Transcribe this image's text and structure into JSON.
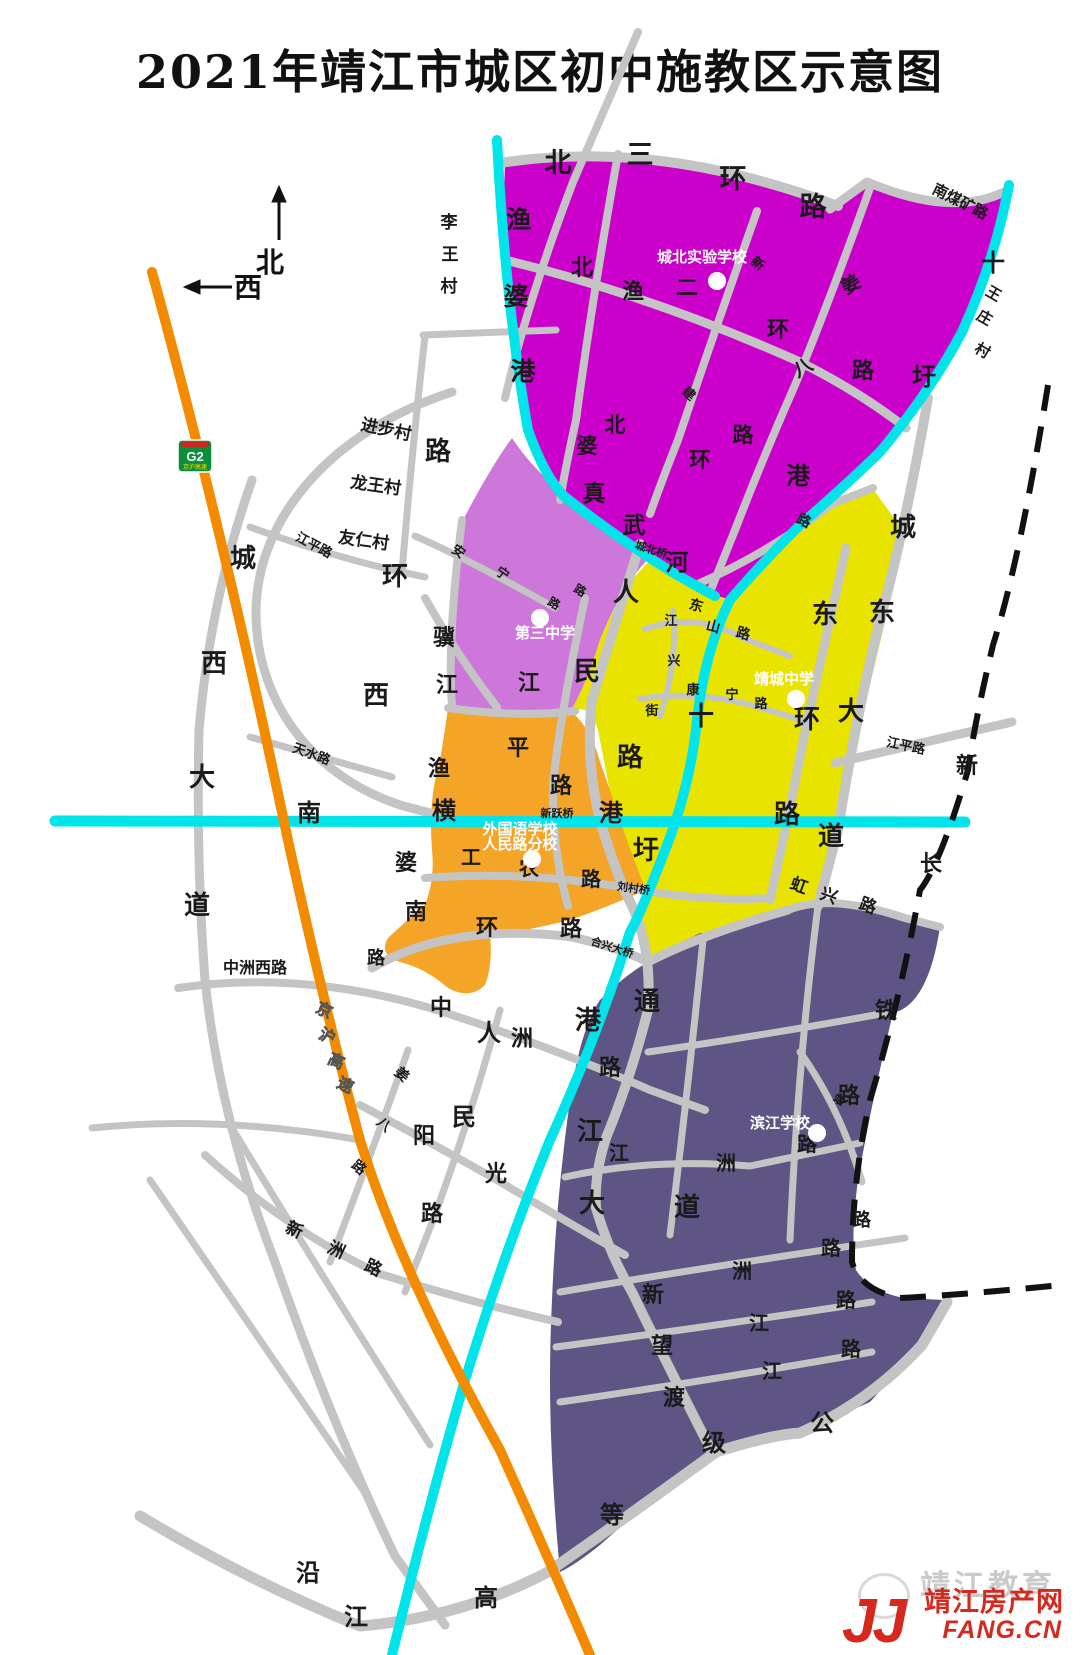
{
  "title": "2021年靖江市城区初中施教区示意图",
  "compass": {
    "north": "北",
    "west": "西"
  },
  "highway_badge": {
    "code": "G2",
    "name": "京沪高速"
  },
  "colors": {
    "district_north": "#cb00cb",
    "district_third": "#cc77d9",
    "district_jingcheng": "#e8e400",
    "district_foreign": "#f4a427",
    "district_binjiang": "#5e5584",
    "road": "#c4c4c4",
    "water": "#00e4ea",
    "highway": "#f28b00",
    "railway": "#111111",
    "label": "#1a1a1a",
    "school_text": "#ffffff",
    "highway_label": "#ffe000",
    "watermark_red": "#d5281e"
  },
  "regions": [
    {
      "school": "城北实验学校",
      "color_key": "district_north"
    },
    {
      "school": "第三中学",
      "color_key": "district_third"
    },
    {
      "school": "靖城中学",
      "color_key": "district_jingcheng"
    },
    {
      "school": "外国语学校人民路分校",
      "color_key": "district_foreign"
    },
    {
      "school": "滨江学校",
      "color_key": "district_binjiang"
    }
  ],
  "schools": [
    {
      "name": "城北实验学校",
      "tx": 702,
      "ty": 262,
      "dx": 717,
      "dy": 281
    },
    {
      "name": "第三中学",
      "tx": 545,
      "ty": 638,
      "dx": 540,
      "dy": 618
    },
    {
      "name": "靖城中学",
      "tx": 784,
      "ty": 684,
      "dx": 796,
      "dy": 699
    },
    {
      "name": "外国语学校",
      "name2": "人民路分校",
      "tx": 520,
      "ty": 834,
      "ty2": 849,
      "dx": 532,
      "dy": 859
    },
    {
      "name": "滨江学校",
      "tx": 780,
      "ty": 1128,
      "dx": 817,
      "dy": 1133
    }
  ],
  "bridges": [
    {
      "t": "城北桥",
      "x": 650,
      "y": 553,
      "s": 11,
      "r": 18
    },
    {
      "t": "新跃桥",
      "x": 557,
      "y": 817,
      "s": 11,
      "r": 0
    },
    {
      "t": "刘村桥",
      "x": 633,
      "y": 892,
      "s": 11,
      "r": 8
    },
    {
      "t": "合兴大桥",
      "x": 611,
      "y": 951,
      "s": 11,
      "r": 18
    }
  ],
  "map_labels": [
    {
      "t": "北",
      "x": 558,
      "y": 172,
      "s": 27
    },
    {
      "t": "三",
      "x": 640,
      "y": 164,
      "s": 27
    },
    {
      "t": "环",
      "x": 733,
      "y": 188,
      "s": 27
    },
    {
      "t": "路",
      "x": 813,
      "y": 216,
      "s": 27
    },
    {
      "t": "南煤矿路",
      "x": 958,
      "y": 206,
      "s": 15,
      "r": 27
    },
    {
      "t": "李",
      "x": 449,
      "y": 228,
      "s": 17
    },
    {
      "t": "王",
      "x": 450,
      "y": 260,
      "s": 17
    },
    {
      "t": "村",
      "x": 449,
      "y": 292,
      "s": 17
    },
    {
      "t": "渔",
      "x": 519,
      "y": 228,
      "s": 25
    },
    {
      "t": "婆",
      "x": 516,
      "y": 305,
      "s": 25
    },
    {
      "t": "港",
      "x": 523,
      "y": 380,
      "s": 25
    },
    {
      "t": "十",
      "x": 993,
      "y": 271,
      "s": 24
    },
    {
      "t": "圩",
      "x": 924,
      "y": 385,
      "s": 24
    },
    {
      "t": "港",
      "x": 798,
      "y": 484,
      "s": 24
    },
    {
      "t": "王",
      "x": 991,
      "y": 298,
      "s": 15,
      "r": 30
    },
    {
      "t": "庄",
      "x": 982,
      "y": 322,
      "s": 15,
      "r": 30
    },
    {
      "t": "村",
      "x": 980,
      "y": 355,
      "s": 15,
      "r": 30
    },
    {
      "t": "新",
      "x": 755,
      "y": 267,
      "s": 13,
      "r": 40
    },
    {
      "t": "建",
      "x": 686,
      "y": 397,
      "s": 13,
      "r": 40
    },
    {
      "t": "北",
      "x": 582,
      "y": 275,
      "s": 22
    },
    {
      "t": "二",
      "x": 687,
      "y": 295,
      "s": 22
    },
    {
      "t": "环",
      "x": 778,
      "y": 337,
      "s": 22
    },
    {
      "t": "路",
      "x": 863,
      "y": 378,
      "s": 22
    },
    {
      "t": "姜",
      "x": 854,
      "y": 290,
      "s": 19,
      "r": -30
    },
    {
      "t": "八",
      "x": 806,
      "y": 373,
      "s": 19,
      "r": -30
    },
    {
      "t": "路",
      "x": 802,
      "y": 525,
      "s": 14,
      "r": 25
    },
    {
      "t": "渔",
      "x": 633,
      "y": 299,
      "s": 22
    },
    {
      "t": "真",
      "x": 594,
      "y": 501,
      "s": 23
    },
    {
      "t": "武",
      "x": 634,
      "y": 533,
      "s": 23
    },
    {
      "t": "河",
      "x": 677,
      "y": 570,
      "s": 23
    },
    {
      "t": "北",
      "x": 615,
      "y": 432,
      "s": 21
    },
    {
      "t": "婆",
      "x": 587,
      "y": 453,
      "s": 21
    },
    {
      "t": "环",
      "x": 700,
      "y": 467,
      "s": 21
    },
    {
      "t": "路",
      "x": 743,
      "y": 442,
      "s": 21
    },
    {
      "t": "城",
      "x": 903,
      "y": 536,
      "s": 26
    },
    {
      "t": "东",
      "x": 882,
      "y": 621,
      "s": 26
    },
    {
      "t": "大",
      "x": 851,
      "y": 720,
      "s": 26
    },
    {
      "t": "道",
      "x": 831,
      "y": 845,
      "s": 26
    },
    {
      "t": "东",
      "x": 825,
      "y": 623,
      "s": 26
    },
    {
      "t": "环",
      "x": 807,
      "y": 728,
      "s": 26
    },
    {
      "t": "路",
      "x": 787,
      "y": 823,
      "s": 26
    },
    {
      "t": "江平路",
      "x": 905,
      "y": 750,
      "s": 13,
      "r": 12
    },
    {
      "t": "江平路",
      "x": 312,
      "y": 549,
      "s": 13,
      "r": 28
    },
    {
      "t": "十",
      "x": 701,
      "y": 725,
      "s": 26
    },
    {
      "t": "圩",
      "x": 646,
      "y": 859,
      "s": 26
    },
    {
      "t": "港",
      "x": 588,
      "y": 1029,
      "s": 26
    },
    {
      "t": "东",
      "x": 695,
      "y": 610,
      "s": 14,
      "r": 15
    },
    {
      "t": "山",
      "x": 712,
      "y": 631,
      "s": 14,
      "r": 15
    },
    {
      "t": "路",
      "x": 742,
      "y": 638,
      "s": 14,
      "r": 15
    },
    {
      "t": "康",
      "x": 693,
      "y": 694,
      "s": 13
    },
    {
      "t": "宁",
      "x": 732,
      "y": 699,
      "s": 13
    },
    {
      "t": "路",
      "x": 761,
      "y": 708,
      "s": 13
    },
    {
      "t": "江",
      "x": 671,
      "y": 625,
      "s": 13
    },
    {
      "t": "兴",
      "x": 674,
      "y": 665,
      "s": 13
    },
    {
      "t": "街",
      "x": 652,
      "y": 715,
      "s": 13
    },
    {
      "t": "人",
      "x": 626,
      "y": 601,
      "s": 26
    },
    {
      "t": "民",
      "x": 587,
      "y": 680,
      "s": 26
    },
    {
      "t": "路",
      "x": 630,
      "y": 766,
      "s": 26
    },
    {
      "t": "骥",
      "x": 444,
      "y": 645,
      "s": 22
    },
    {
      "t": "江",
      "x": 447,
      "y": 692,
      "s": 22
    },
    {
      "t": "江",
      "x": 529,
      "y": 690,
      "s": 22
    },
    {
      "t": "平",
      "x": 518,
      "y": 755,
      "s": 22
    },
    {
      "t": "路",
      "x": 561,
      "y": 793,
      "s": 22
    },
    {
      "t": "路",
      "x": 438,
      "y": 460,
      "s": 26
    },
    {
      "t": "环",
      "x": 395,
      "y": 585,
      "s": 26
    },
    {
      "t": "西",
      "x": 376,
      "y": 704,
      "s": 26
    },
    {
      "t": "城",
      "x": 243,
      "y": 567,
      "s": 26
    },
    {
      "t": "西",
      "x": 214,
      "y": 672,
      "s": 26
    },
    {
      "t": "大",
      "x": 202,
      "y": 786,
      "s": 26
    },
    {
      "t": "道",
      "x": 197,
      "y": 914,
      "s": 26
    },
    {
      "t": "进步村",
      "x": 385,
      "y": 435,
      "s": 17,
      "r": 12
    },
    {
      "t": "龙王村",
      "x": 375,
      "y": 491,
      "s": 17,
      "r": 8
    },
    {
      "t": "友仁村",
      "x": 363,
      "y": 546,
      "s": 17,
      "r": 8
    },
    {
      "t": "安",
      "x": 456,
      "y": 555,
      "s": 13,
      "r": 35
    },
    {
      "t": "宁",
      "x": 500,
      "y": 577,
      "s": 13,
      "r": 35
    },
    {
      "t": "路",
      "x": 552,
      "y": 607,
      "s": 12,
      "r": 30
    },
    {
      "t": "路",
      "x": 578,
      "y": 594,
      "s": 12,
      "r": 30
    },
    {
      "t": "天水路",
      "x": 310,
      "y": 758,
      "s": 13,
      "r": 20
    },
    {
      "t": "南",
      "x": 309,
      "y": 821,
      "s": 24
    },
    {
      "t": "横",
      "x": 444,
      "y": 819,
      "s": 24
    },
    {
      "t": "港",
      "x": 611,
      "y": 821,
      "s": 24
    },
    {
      "t": "渔",
      "x": 439,
      "y": 776,
      "s": 22
    },
    {
      "t": "婆",
      "x": 406,
      "y": 870,
      "s": 22
    },
    {
      "t": "南",
      "x": 416,
      "y": 919,
      "s": 22
    },
    {
      "t": "环",
      "x": 487,
      "y": 935,
      "s": 22
    },
    {
      "t": "路",
      "x": 571,
      "y": 936,
      "s": 22
    },
    {
      "t": "路",
      "x": 376,
      "y": 964,
      "s": 18
    },
    {
      "t": "工",
      "x": 471,
      "y": 864,
      "s": 20
    },
    {
      "t": "农",
      "x": 529,
      "y": 875,
      "s": 20
    },
    {
      "t": "路",
      "x": 591,
      "y": 886,
      "s": 20
    },
    {
      "t": "虹",
      "x": 797,
      "y": 891,
      "s": 17,
      "r": 20
    },
    {
      "t": "兴",
      "x": 827,
      "y": 901,
      "s": 17,
      "r": 20
    },
    {
      "t": "路",
      "x": 866,
      "y": 911,
      "s": 17,
      "r": 20
    },
    {
      "t": "新",
      "x": 967,
      "y": 773,
      "s": 22
    },
    {
      "t": "长",
      "x": 931,
      "y": 871,
      "s": 22
    },
    {
      "t": "铁",
      "x": 886,
      "y": 1018,
      "s": 22
    },
    {
      "t": "路",
      "x": 849,
      "y": 1103,
      "s": 22
    },
    {
      "t": "中洲西路",
      "x": 255,
      "y": 973,
      "s": 16
    },
    {
      "t": "京",
      "x": 322,
      "y": 1015,
      "s": 16,
      "r": 25,
      "c": "#ffe000"
    },
    {
      "t": "沪",
      "x": 325,
      "y": 1041,
      "s": 16,
      "r": 25,
      "c": "#ffe000"
    },
    {
      "t": "高",
      "x": 334,
      "y": 1066,
      "s": 16,
      "r": 25,
      "c": "#ffe000"
    },
    {
      "t": "速",
      "x": 343,
      "y": 1090,
      "s": 16,
      "r": 25,
      "c": "#ffe000"
    },
    {
      "t": "中",
      "x": 441,
      "y": 1015,
      "s": 22
    },
    {
      "t": "洲",
      "x": 522,
      "y": 1046,
      "s": 22
    },
    {
      "t": "路",
      "x": 610,
      "y": 1075,
      "s": 22
    },
    {
      "t": "通",
      "x": 647,
      "y": 1010,
      "s": 26
    },
    {
      "t": "江",
      "x": 590,
      "y": 1140,
      "s": 26
    },
    {
      "t": "大",
      "x": 592,
      "y": 1212,
      "s": 26
    },
    {
      "t": "道",
      "x": 687,
      "y": 1216,
      "s": 26
    },
    {
      "t": "姜",
      "x": 399,
      "y": 1078,
      "s": 14,
      "r": 40
    },
    {
      "t": "八",
      "x": 381,
      "y": 1128,
      "s": 14,
      "r": 40
    },
    {
      "t": "路",
      "x": 356,
      "y": 1171,
      "s": 14,
      "r": 40
    },
    {
      "t": "人",
      "x": 489,
      "y": 1041,
      "s": 24
    },
    {
      "t": "民",
      "x": 464,
      "y": 1125,
      "s": 24
    },
    {
      "t": "阳",
      "x": 424,
      "y": 1143,
      "s": 22
    },
    {
      "t": "光",
      "x": 496,
      "y": 1181,
      "s": 22
    },
    {
      "t": "路",
      "x": 432,
      "y": 1221,
      "s": 22
    },
    {
      "t": "新",
      "x": 292,
      "y": 1235,
      "s": 17,
      "r": 25
    },
    {
      "t": "洲",
      "x": 334,
      "y": 1255,
      "s": 17,
      "r": 25
    },
    {
      "t": "路",
      "x": 371,
      "y": 1273,
      "s": 17,
      "r": 25
    },
    {
      "t": "站",
      "x": 837,
      "y": 1103,
      "s": 11,
      "r": 30
    },
    {
      "t": "江",
      "x": 619,
      "y": 1160,
      "s": 20
    },
    {
      "t": "洲",
      "x": 726,
      "y": 1170,
      "s": 20
    },
    {
      "t": "路",
      "x": 807,
      "y": 1151,
      "s": 20
    },
    {
      "t": "路",
      "x": 862,
      "y": 1226,
      "s": 18
    },
    {
      "t": "新",
      "x": 653,
      "y": 1302,
      "s": 22
    },
    {
      "t": "望",
      "x": 662,
      "y": 1353,
      "s": 22
    },
    {
      "t": "渡",
      "x": 674,
      "y": 1405,
      "s": 22
    },
    {
      "t": "洲",
      "x": 742,
      "y": 1278,
      "s": 20
    },
    {
      "t": "路",
      "x": 831,
      "y": 1255,
      "s": 20
    },
    {
      "t": "江",
      "x": 759,
      "y": 1330,
      "s": 20
    },
    {
      "t": "路",
      "x": 846,
      "y": 1307,
      "s": 20
    },
    {
      "t": "江",
      "x": 772,
      "y": 1378,
      "s": 20
    },
    {
      "t": "路",
      "x": 851,
      "y": 1356,
      "s": 20
    },
    {
      "t": "沿",
      "x": 308,
      "y": 1581,
      "s": 24
    },
    {
      "t": "江",
      "x": 356,
      "y": 1625,
      "s": 24
    },
    {
      "t": "高",
      "x": 486,
      "y": 1606,
      "s": 24
    },
    {
      "t": "等",
      "x": 612,
      "y": 1523,
      "s": 24
    },
    {
      "t": "级",
      "x": 714,
      "y": 1451,
      "s": 24
    },
    {
      "t": "公",
      "x": 822,
      "y": 1431,
      "s": 24
    }
  ],
  "watermark": {
    "ghost": "靖江教育",
    "logo": "JJ",
    "site": "靖江房产网",
    "url": "FANG.CN"
  }
}
